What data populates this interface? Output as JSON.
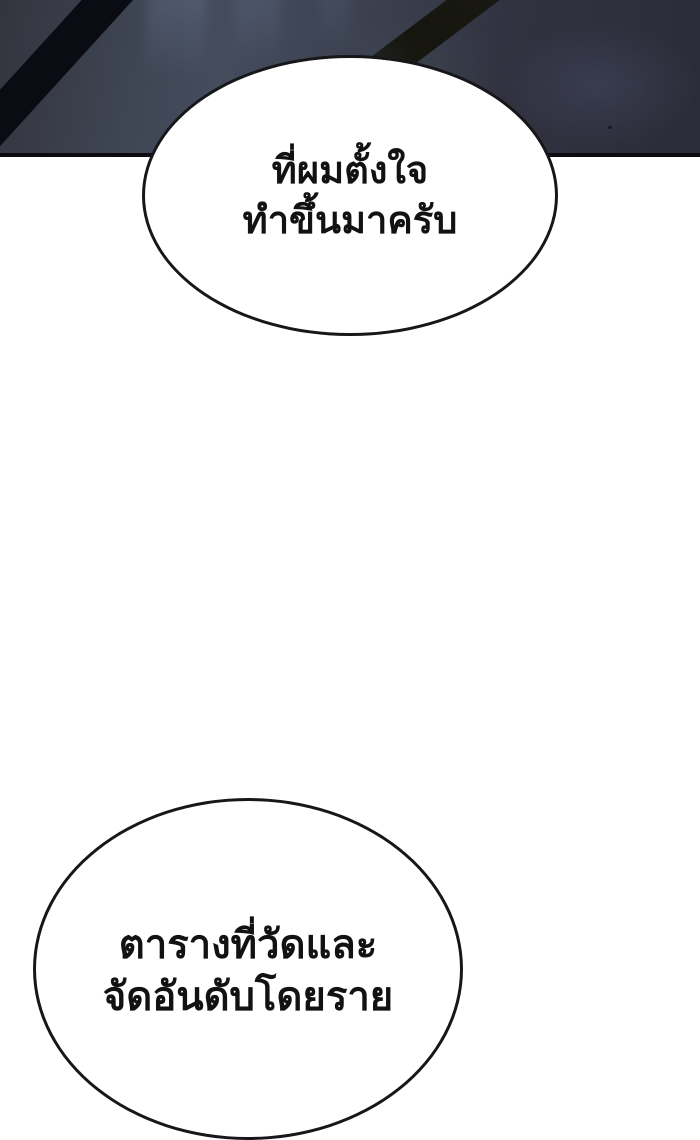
{
  "page": {
    "kind": "webtoon-comic-panel",
    "background": "#ffffff"
  },
  "scene": {
    "description": "dark slate scene with diagonal black beams",
    "base_color": "#34343e",
    "highlight_color": "#444c5d",
    "shadow_color": "#2c2c38",
    "corner_stripe_color": "#0b0b13",
    "beam_color": "#16160f",
    "bottom_border_color": "#0c0c10"
  },
  "bubbles": [
    {
      "name": "speech-bubble-top",
      "fill": "#ffffff",
      "stroke": "#17171b",
      "text_color": "#121215",
      "lines": [
        "ที่ผมตั้งใจ",
        "ทำขึ้นมาครับ"
      ]
    },
    {
      "name": "speech-bubble-bottom",
      "fill": "#ffffff",
      "stroke": "#17171b",
      "text_color": "#121215",
      "clipped": "bottom edge of image",
      "lines": [
        "ตารางที่วัดและ",
        "จัดอันดับโดยราย"
      ]
    }
  ]
}
